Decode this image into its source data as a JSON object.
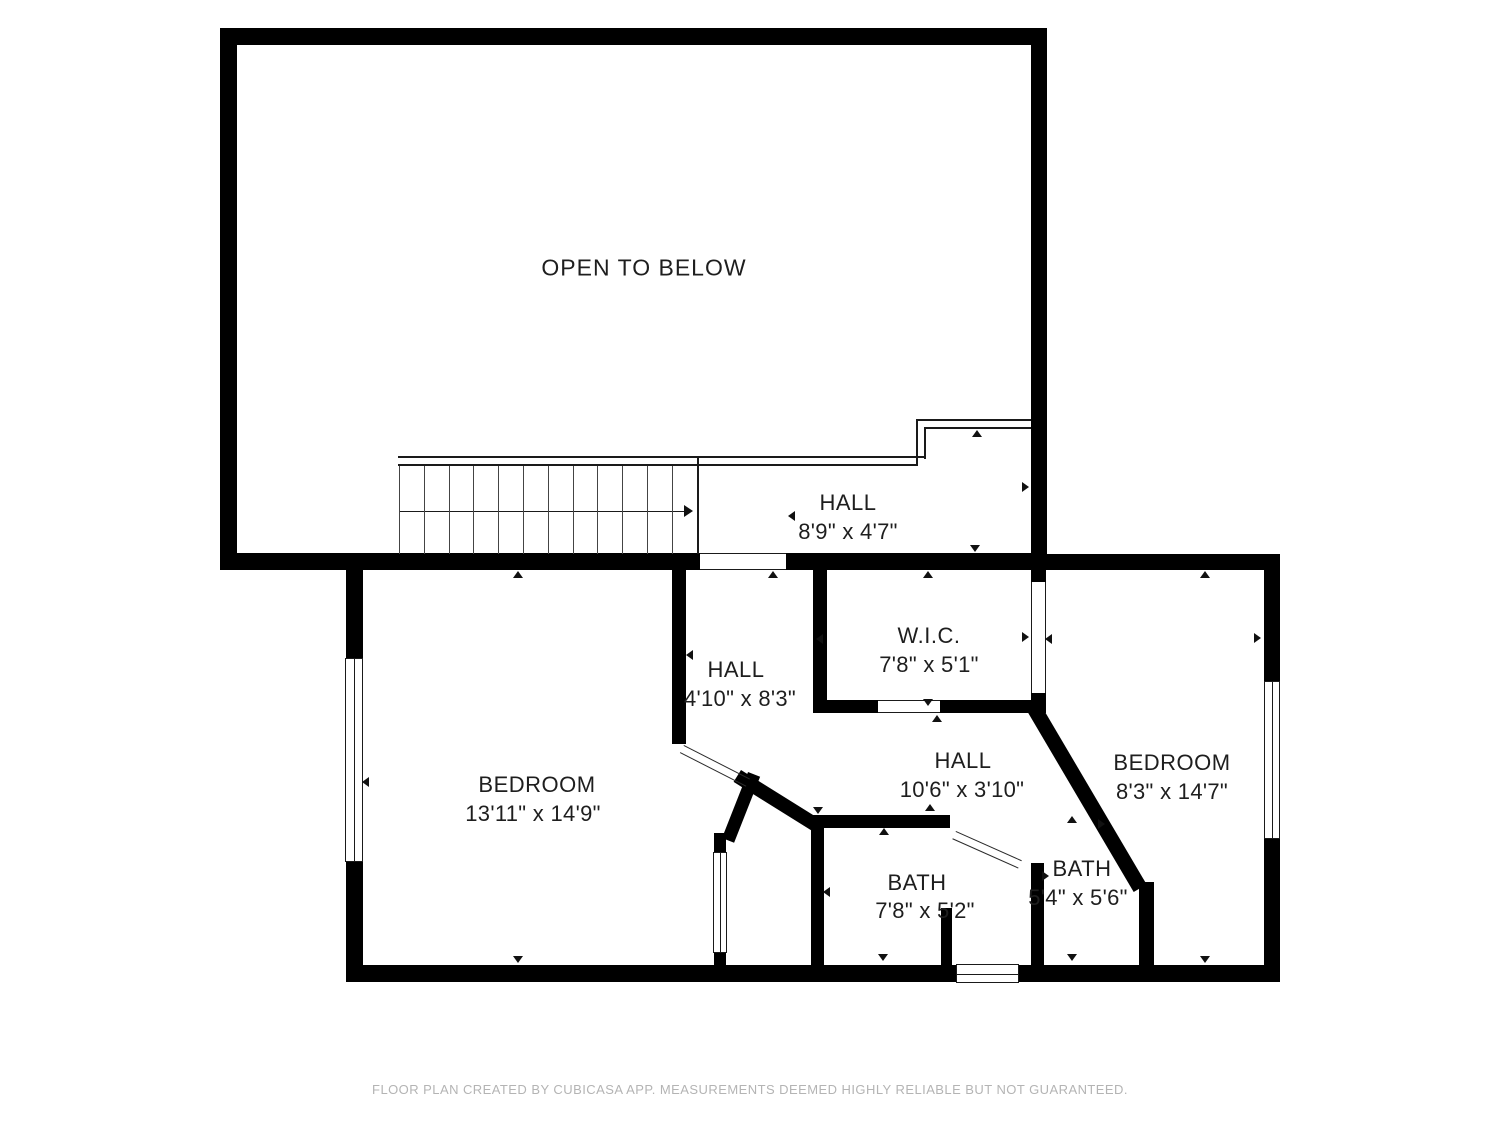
{
  "colors": {
    "wall": "#000000",
    "text": "#1e1e1e",
    "footer": "#b4b4b4",
    "background": "#ffffff"
  },
  "footer": {
    "text": "FLOOR PLAN CREATED BY CUBICASA APP. MEASUREMENTS DEEMED HIGHLY RELIABLE BUT NOT GUARANTEED."
  },
  "rooms": [
    {
      "id": "open-to-below",
      "name": "OPEN TO BELOW",
      "dims": "",
      "nx": 644,
      "ny": 268,
      "dx": 0,
      "dy": 0,
      "big": true
    },
    {
      "id": "hall-upper",
      "name": "HALL",
      "dims": "8'9\" x 4'7\"",
      "nx": 848,
      "ny": 503,
      "dx": 848,
      "dy": 532,
      "big": false
    },
    {
      "id": "hall-center",
      "name": "HALL",
      "dims": "4'10\" x 8'3\"",
      "nx": 736,
      "ny": 670,
      "dx": 740,
      "dy": 699,
      "big": false
    },
    {
      "id": "wic",
      "name": "W.I.C.",
      "dims": "7'8\" x 5'1\"",
      "nx": 929,
      "ny": 636,
      "dx": 929,
      "dy": 665,
      "big": false
    },
    {
      "id": "hall-lower",
      "name": "HALL",
      "dims": "10'6\" x 3'10\"",
      "nx": 963,
      "ny": 761,
      "dx": 962,
      "dy": 790,
      "big": false
    },
    {
      "id": "bedroom-left",
      "name": "BEDROOM",
      "dims": "13'11\" x 14'9\"",
      "nx": 537,
      "ny": 785,
      "dx": 533,
      "dy": 814,
      "big": false
    },
    {
      "id": "bedroom-right",
      "name": "BEDROOM",
      "dims": "8'3\" x 14'7\"",
      "nx": 1172,
      "ny": 763,
      "dx": 1172,
      "dy": 792,
      "big": false
    },
    {
      "id": "bath-left",
      "name": "BATH",
      "dims": "7'8\" x 5'2\"",
      "nx": 917,
      "ny": 883,
      "dx": 925,
      "dy": 911,
      "big": false
    },
    {
      "id": "bath-right",
      "name": "BATH",
      "dims": "5'4\" x 5'6\"",
      "nx": 1082,
      "ny": 869,
      "dx": 1078,
      "dy": 898,
      "big": false
    }
  ],
  "walls": [
    [
      220,
      28,
      827,
      17
    ],
    [
      220,
      28,
      17,
      542
    ],
    [
      1031,
      28,
      16,
      542
    ],
    [
      220,
      553,
      480,
      17
    ],
    [
      786,
      553,
      261,
      17
    ],
    [
      1047,
      554,
      233,
      16
    ],
    [
      346,
      554,
      17,
      106
    ],
    [
      346,
      860,
      17,
      122
    ],
    [
      346,
      965,
      934,
      17
    ],
    [
      1264,
      554,
      16,
      129
    ],
    [
      1264,
      837,
      16,
      145
    ],
    [
      672,
      570,
      14,
      174
    ],
    [
      813,
      570,
      14,
      143
    ],
    [
      813,
      700,
      65,
      13
    ],
    [
      940,
      700,
      106,
      13
    ],
    [
      1031,
      570,
      15,
      12
    ],
    [
      1031,
      693,
      15,
      20
    ],
    [
      1139,
      882,
      15,
      100
    ],
    [
      811,
      815,
      13,
      150
    ],
    [
      817,
      815,
      133,
      13
    ],
    [
      714,
      833,
      12,
      21
    ],
    [
      714,
      951,
      12,
      31
    ],
    [
      1031,
      863,
      13,
      102
    ],
    [
      941,
      908,
      11,
      57
    ]
  ],
  "diag_walls": [
    [
      722,
      838,
      71,
      13,
      -68.5
    ],
    [
      741,
      770,
      94,
      14,
      32
    ],
    [
      1038,
      700,
      214,
      15,
      59.5
    ]
  ],
  "doors": [
    [
      684,
      745,
      74,
      27
    ],
    [
      956,
      831,
      72,
      24
    ]
  ],
  "windows": [
    [
      345,
      658,
      18,
      204,
      "v"
    ],
    [
      1264,
      681,
      16,
      158,
      "v"
    ],
    [
      956,
      964,
      63,
      19,
      "h"
    ],
    [
      713,
      852,
      14,
      101,
      "v"
    ]
  ],
  "lines": [
    [
      700,
      553,
      86,
      1.4
    ],
    [
      700,
      568.6,
      86,
      1.4
    ],
    [
      1031,
      582,
      1.4,
      111
    ],
    [
      1044.6,
      582,
      1.4,
      111
    ],
    [
      878,
      700,
      62,
      1.4
    ],
    [
      878,
      711.6,
      62,
      1.4
    ],
    [
      398,
      456,
      527,
      1.6
    ],
    [
      398,
      464.4,
      519,
      1.6
    ],
    [
      916,
      419,
      115,
      1.6
    ],
    [
      924,
      427,
      107,
      1.6
    ],
    [
      916,
      419,
      1.6,
      47
    ],
    [
      924,
      427,
      1.6,
      31.6
    ],
    [
      697,
      456,
      2,
      98
    ],
    [
      399,
      510.5,
      290,
      1.6
    ]
  ],
  "stairs": {
    "tread_xs": [
      399,
      424,
      449,
      473,
      498,
      523,
      548,
      573,
      597,
      622,
      647,
      672
    ],
    "y": 466,
    "h": 88,
    "w": 1.2
  },
  "markers": [
    [
      518,
      575,
      "up",
      5.5
    ],
    [
      518,
      960,
      "down",
      5.5
    ],
    [
      366,
      782,
      "left",
      5.5
    ],
    [
      792,
      516,
      "left",
      5.5
    ],
    [
      1026,
      487,
      "right",
      5.5
    ],
    [
      977,
      434,
      "up",
      5.5
    ],
    [
      975,
      549,
      "down",
      5.5
    ],
    [
      773,
      575,
      "up",
      5.5
    ],
    [
      690,
      655,
      "left",
      5.5
    ],
    [
      928,
      575,
      "up",
      5.5
    ],
    [
      928,
      703,
      "down",
      5.5
    ],
    [
      820,
      639,
      "left",
      5.5
    ],
    [
      1026,
      637,
      "right",
      5.5
    ],
    [
      1049,
      639,
      "left",
      5.5
    ],
    [
      937,
      719,
      "up",
      5.5
    ],
    [
      1205,
      575,
      "up",
      5.5
    ],
    [
      1258,
      638,
      "right",
      5.5
    ],
    [
      1205,
      960,
      "down",
      5.5
    ],
    [
      818,
      811,
      "down",
      5.5
    ],
    [
      884,
      832,
      "up",
      5.5
    ],
    [
      883,
      958,
      "down",
      5.5
    ],
    [
      827,
      892,
      "left",
      5.5
    ],
    [
      1072,
      820,
      "up",
      5.5
    ],
    [
      1102,
      824,
      "right",
      5.5
    ],
    [
      1046,
      876,
      "right",
      5.5
    ],
    [
      1072,
      958,
      "down",
      5.5
    ],
    [
      930,
      808,
      "up",
      5.5
    ],
    [
      689,
      511,
      "right",
      6.5
    ]
  ]
}
